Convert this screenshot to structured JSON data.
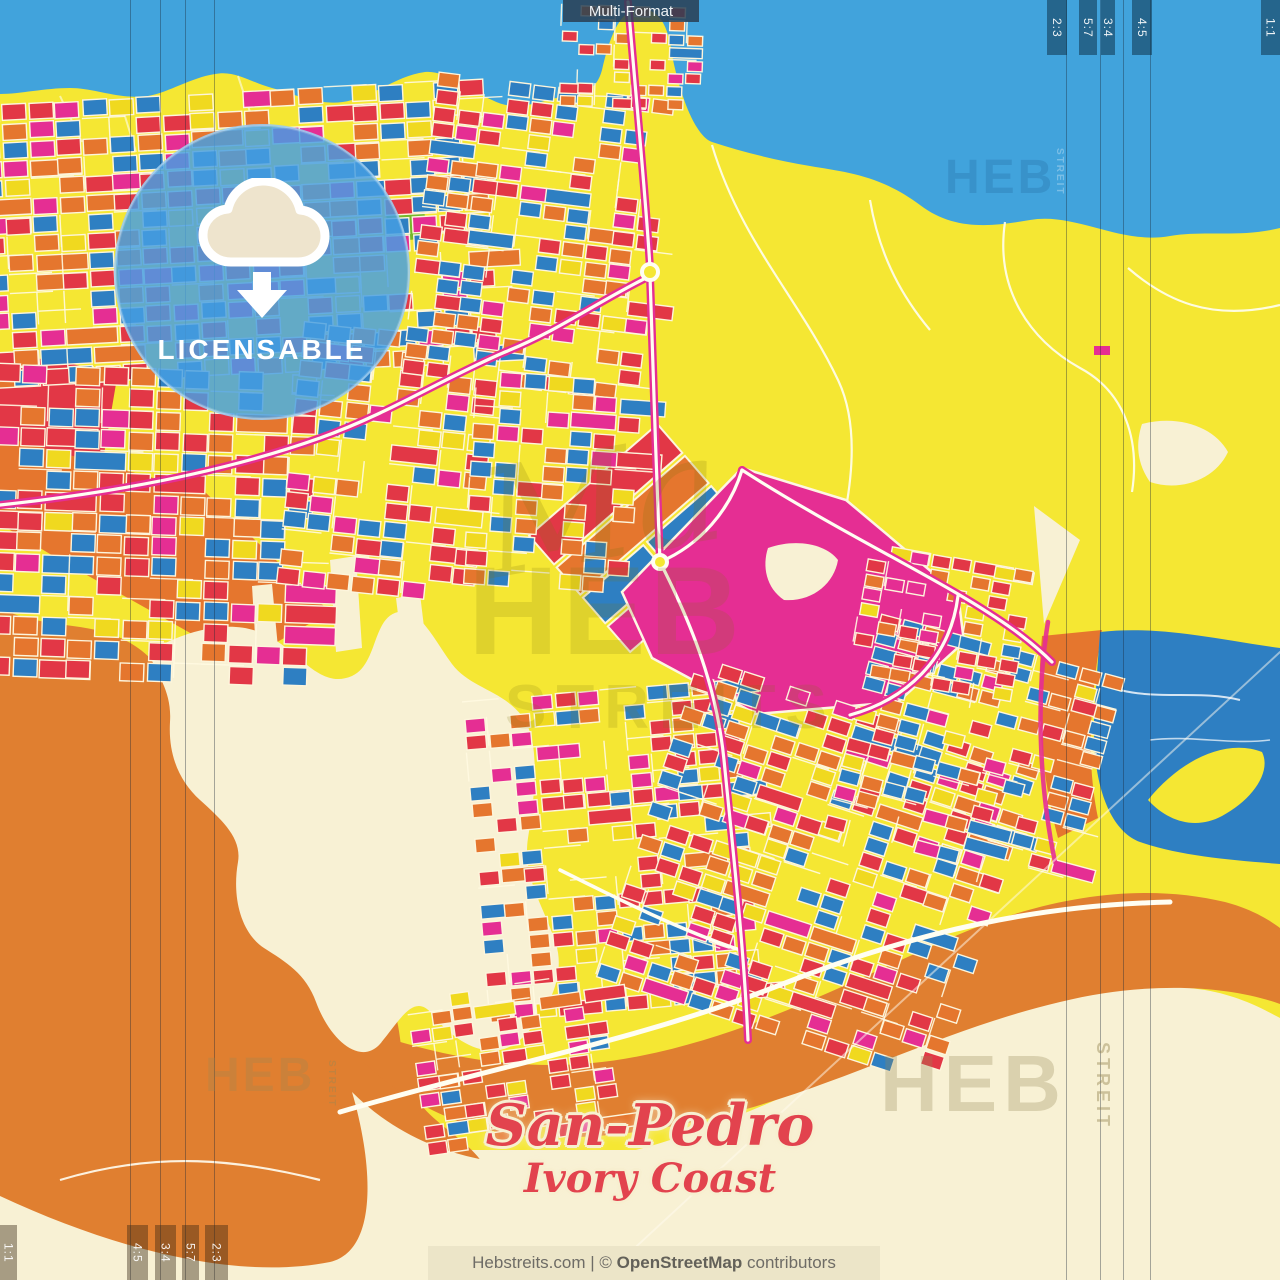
{
  "header": {
    "format_label": "Multi-Format"
  },
  "badge": {
    "label": "LICENSABLE",
    "icon": "cloud-download-icon"
  },
  "title": {
    "city": "San-Pedro",
    "country": "Ivory Coast"
  },
  "footer": {
    "prefix": "Hebstreits.com | © ",
    "osm": "OpenStreetMap",
    "suffix": " contributors"
  },
  "ratios": {
    "top_right": [
      "2:3",
      "5:7",
      "3:4",
      "4:5"
    ],
    "top_right_edge": "1:1",
    "bottom_left": [
      "4:5",
      "3:4",
      "5:7",
      "2:3"
    ],
    "bottom_left_edge": "1:1"
  },
  "watermarks": {
    "script": "Ma",
    "heb": "HEB",
    "streits": "STREITS",
    "streit_vertical": "STREIT"
  },
  "colors": {
    "water": "#41a3dc",
    "land_yellow": "#f5e733",
    "terrain_orange": "#e07f30",
    "paper_cream": "#f8f1d4",
    "block_red": "#e23746",
    "block_magenta": "#e52e93",
    "block_blue": "#2e7fc2",
    "block_orange": "#e5762e",
    "title_red": "#e2434e"
  }
}
